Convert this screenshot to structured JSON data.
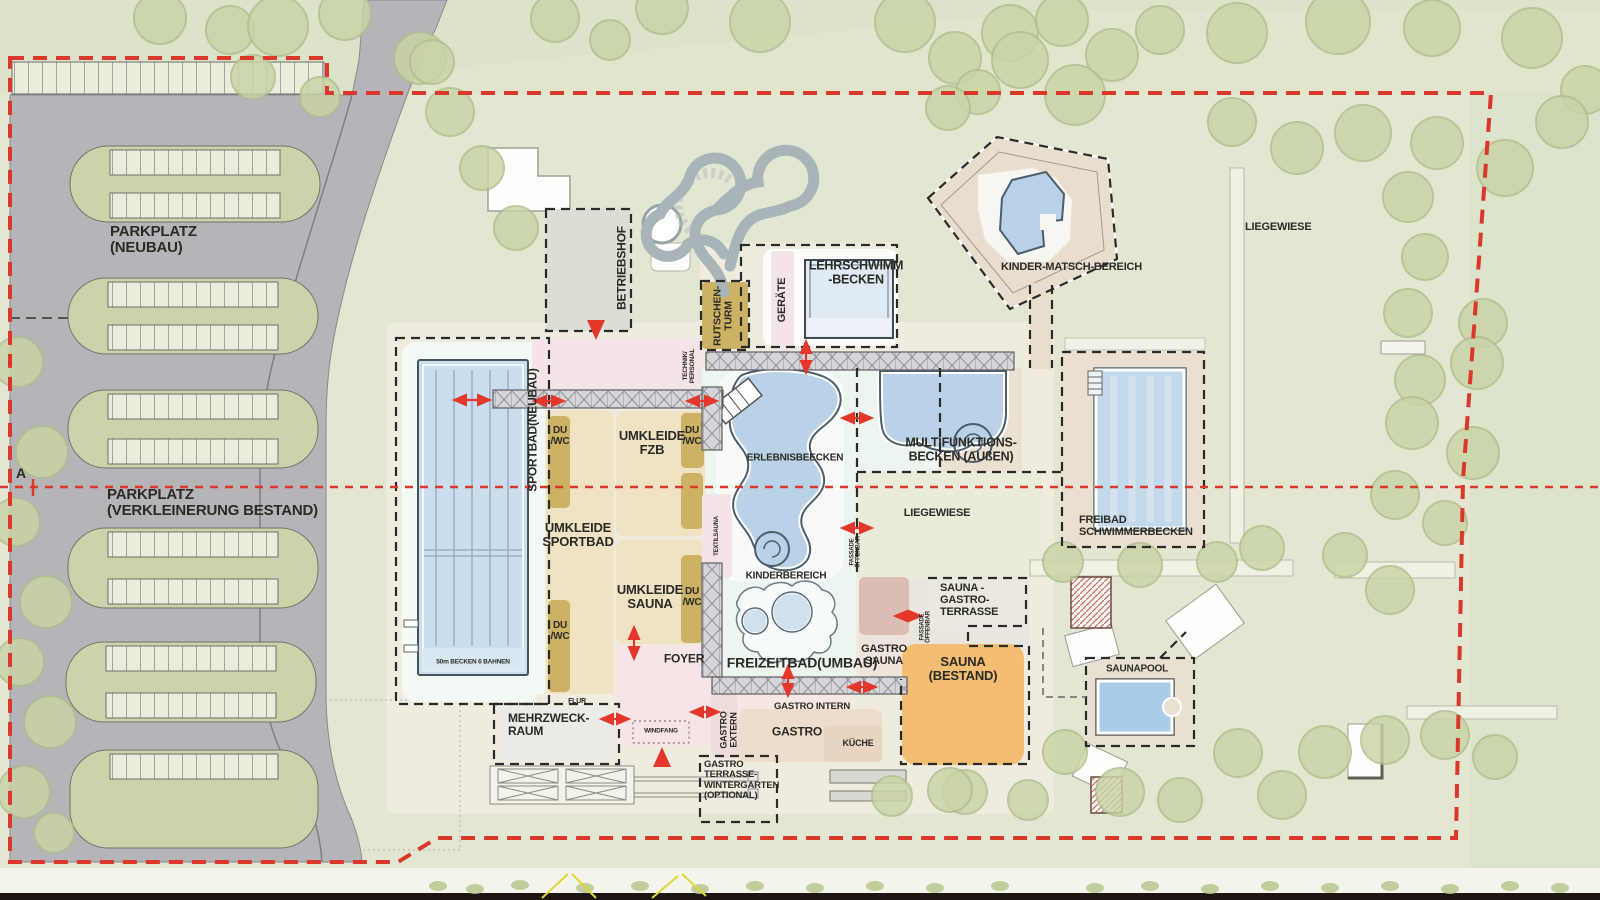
{
  "site": {
    "boundary_color": "#d9382b",
    "section_line_color": "#d9382b",
    "arrow_color": "#e2372a",
    "pool_color": "#b9d2e7",
    "sauna_orange": "#f3bd72",
    "gold": "#cdb266",
    "section_marker": "A"
  },
  "labels": [
    {
      "id": "parkplatz-neubau",
      "text": "PARKPLATZ\n(NEUBAU)",
      "x": 110,
      "y": 224,
      "s": 15,
      "a": "l"
    },
    {
      "id": "parkplatz-bestand",
      "text": "PARKPLATZ\n(VERKLEINERUNG BESTAND)",
      "x": 107,
      "y": 487,
      "s": 15,
      "a": "l"
    },
    {
      "id": "section-a",
      "text": "A",
      "x": 16,
      "y": 466,
      "s": 14,
      "a": "l"
    },
    {
      "id": "betriebshof",
      "text": "BETRIEBSHOF",
      "x": 622,
      "y": 268,
      "s": 12,
      "a": "r"
    },
    {
      "id": "rutschen-turm",
      "text": "RUTSCHEN-\nTURM",
      "x": 724,
      "y": 316,
      "s": 10.5,
      "a": "r"
    },
    {
      "id": "geraete",
      "text": "GERÄTE",
      "x": 783,
      "y": 300,
      "s": 11,
      "a": "r"
    },
    {
      "id": "lehrschwimm-becken",
      "text": "LEHRSCHWIMM\n-BECKEN",
      "x": 856,
      "y": 273,
      "s": 12.5,
      "a": "c"
    },
    {
      "id": "kinder-matsch-bereich",
      "text": "KINDER-MATSCH-BEREICH",
      "x": 1001,
      "y": 262,
      "s": 11,
      "a": "l"
    },
    {
      "id": "liegewiese-top",
      "text": "LIEGEWIESE",
      "x": 1245,
      "y": 222,
      "s": 11,
      "a": "l"
    },
    {
      "id": "sportbad-neubau",
      "text": "SPORTBAD(NEUBAU)",
      "x": 533,
      "y": 430,
      "s": 12,
      "a": "r"
    },
    {
      "id": "technik-personal",
      "text": "TECHNIK/\nPERSONAL",
      "x": 689,
      "y": 366,
      "s": 6.5,
      "a": "r"
    },
    {
      "id": "du-wc-1",
      "text": "DU\n/WC",
      "x": 560,
      "y": 437,
      "s": 10,
      "a": "c"
    },
    {
      "id": "du-wc-2",
      "text": "DU\n/WC",
      "x": 560,
      "y": 632,
      "s": 10,
      "a": "c"
    },
    {
      "id": "du-wc-3",
      "text": "DU\n/WC",
      "x": 692,
      "y": 437,
      "s": 10,
      "a": "c"
    },
    {
      "id": "du-wc-4",
      "text": "DU\n/WC",
      "x": 692,
      "y": 598,
      "s": 10,
      "a": "c"
    },
    {
      "id": "umkleide-fzb",
      "text": "UMKLEIDE\nFZB",
      "x": 652,
      "y": 443,
      "s": 13,
      "a": "c"
    },
    {
      "id": "umkleide-sportbad",
      "text": "UMKLEIDE\nSPORTBAD",
      "x": 578,
      "y": 535,
      "s": 13,
      "a": "c"
    },
    {
      "id": "umkleide-sauna",
      "text": "UMKLEIDE\nSAUNA",
      "x": 650,
      "y": 597,
      "s": 13,
      "a": "c"
    },
    {
      "id": "erlebnisbecken",
      "text": "ERLEBNISBEECKEN",
      "x": 795,
      "y": 459,
      "s": 10,
      "a": "c"
    },
    {
      "id": "multifunktionsbecken",
      "text": "MULTIFUNKTIONS-\nBECKEN (AUßEN)",
      "x": 961,
      "y": 450,
      "s": 12.5,
      "a": "c"
    },
    {
      "id": "liegewiese-mitte",
      "text": "LIEGEWIESE",
      "x": 937,
      "y": 514,
      "s": 11,
      "a": "c"
    },
    {
      "id": "freibad-schwimmerbecken",
      "text": "FREIBAD\nSCHWIMMERBECKEN",
      "x": 1079,
      "y": 515,
      "s": 11,
      "a": "l"
    },
    {
      "id": "textilsauna",
      "text": "TEXTILSAUNA",
      "x": 717,
      "y": 536,
      "s": 6,
      "a": "r"
    },
    {
      "id": "fassade-oeffenbar-1",
      "text": "FASSADE\nÖFFENBAR",
      "x": 856,
      "y": 552,
      "s": 6,
      "a": "r"
    },
    {
      "id": "fassade-oeffenbar-2",
      "text": "FASSADE\nÖFFENBAR",
      "x": 926,
      "y": 627,
      "s": 6,
      "a": "r"
    },
    {
      "id": "kinderbereich",
      "text": "KINDERBEREICH",
      "x": 786,
      "y": 577,
      "s": 10,
      "a": "c"
    },
    {
      "id": "freizeitbad-umbau",
      "text": "FREIZEITBAD(UMBAU)",
      "x": 802,
      "y": 663,
      "s": 14,
      "a": "c"
    },
    {
      "id": "sauna-gastro-terrasse",
      "text": "SAUNA -\nGASTRO-\nTERRASSE",
      "x": 940,
      "y": 583,
      "s": 11,
      "a": "l"
    },
    {
      "id": "gastro-sauna",
      "text": "GASTRO\nSAUNA",
      "x": 884,
      "y": 656,
      "s": 11,
      "a": "c"
    },
    {
      "id": "sauna-bestand",
      "text": "SAUNA\n(BESTAND)",
      "x": 963,
      "y": 669,
      "s": 13,
      "a": "c"
    },
    {
      "id": "saunapool",
      "text": "SAUNAPOOL",
      "x": 1137,
      "y": 670,
      "s": 10,
      "a": "c"
    },
    {
      "id": "foyer",
      "text": "FOYER",
      "x": 684,
      "y": 659,
      "s": 12,
      "a": "c"
    },
    {
      "id": "flur",
      "text": "FLUR",
      "x": 577,
      "y": 702,
      "s": 7,
      "a": "c"
    },
    {
      "id": "mehrzweck-raum",
      "text": "MEHRZWECK-\nRAUM",
      "x": 508,
      "y": 712,
      "s": 12,
      "a": "l"
    },
    {
      "id": "windfang",
      "text": "WINDFANG",
      "x": 661,
      "y": 731,
      "s": 6.5,
      "a": "c"
    },
    {
      "id": "gastro-extern",
      "text": "GASTRO\nEXTERN",
      "x": 729,
      "y": 730,
      "s": 9,
      "a": "r"
    },
    {
      "id": "gastro-intern",
      "text": "GASTRO INTERN",
      "x": 812,
      "y": 707,
      "s": 9.5,
      "a": "c"
    },
    {
      "id": "gastro",
      "text": "GASTRO",
      "x": 797,
      "y": 732,
      "s": 12,
      "a": "c"
    },
    {
      "id": "kueche",
      "text": "KÜCHE",
      "x": 858,
      "y": 744,
      "s": 9,
      "a": "c"
    },
    {
      "id": "gastro-terrasse-wintergarten",
      "text": "GASTRO\nTERRASSE-\nWINTERGARTEN\n(OPTIONAL)",
      "x": 704,
      "y": 760,
      "s": 9.5,
      "a": "l"
    },
    {
      "id": "becken-50m",
      "text": "50m BECKEN 6 BAHNEN",
      "x": 473,
      "y": 662,
      "s": 6.5,
      "a": "c"
    }
  ],
  "blocks": [
    {
      "id": "sportbad-halle",
      "x": 402,
      "y": 342,
      "w": 143,
      "h": 360,
      "bg": "#f3faf6",
      "rx": 14
    },
    {
      "id": "technik-strip",
      "x": 532,
      "y": 338,
      "w": 170,
      "h": 52,
      "bg": "#f5e4e7",
      "rx": 8
    },
    {
      "id": "betriebshof-hof",
      "x": 546,
      "y": 209,
      "w": 85,
      "h": 122,
      "bg": "#dcddd4",
      "rx": 2
    },
    {
      "id": "umkleide-sportbad-block",
      "x": 546,
      "y": 410,
      "w": 68,
      "h": 288,
      "bg": "#f0e3c3",
      "rx": 10
    },
    {
      "id": "umkleide-fzb-block",
      "x": 616,
      "y": 411,
      "w": 89,
      "h": 125,
      "bg": "#f0e3c3",
      "rx": 8
    },
    {
      "id": "umkleide-sauna-block",
      "x": 616,
      "y": 540,
      "w": 89,
      "h": 104,
      "bg": "#f0e3c3",
      "rx": 8
    },
    {
      "id": "foyer-block",
      "x": 616,
      "y": 646,
      "w": 95,
      "h": 100,
      "bg": "#f6e4e7",
      "rx": 8
    },
    {
      "id": "flur-strip",
      "x": 536,
      "y": 694,
      "w": 78,
      "h": 16,
      "bg": "#f0ecdf",
      "rx": 3
    },
    {
      "id": "du-wc-box-1",
      "x": 548,
      "y": 416,
      "w": 22,
      "h": 92,
      "bg": "#cdb266",
      "rx": 5
    },
    {
      "id": "du-wc-box-2",
      "x": 548,
      "y": 600,
      "w": 22,
      "h": 92,
      "bg": "#cdb266",
      "rx": 5
    },
    {
      "id": "du-wc-box-3",
      "x": 681,
      "y": 413,
      "w": 23,
      "h": 55,
      "bg": "#cdb266",
      "rx": 5
    },
    {
      "id": "du-wc-box-4",
      "x": 681,
      "y": 473,
      "w": 22,
      "h": 56,
      "bg": "#cdb266",
      "rx": 5
    },
    {
      "id": "du-wc-box-5",
      "x": 681,
      "y": 555,
      "w": 22,
      "h": 88,
      "bg": "#cdb266",
      "rx": 5
    },
    {
      "id": "textilsauna-box",
      "x": 702,
      "y": 494,
      "w": 30,
      "h": 84,
      "bg": "#f5e4e7",
      "rx": 4
    },
    {
      "id": "lehrschwimm-box",
      "x": 763,
      "y": 249,
      "w": 135,
      "h": 97,
      "bg": "#fcfdfb",
      "rx": 10
    },
    {
      "id": "geraete-strip",
      "x": 771,
      "y": 251,
      "w": 23,
      "h": 99,
      "bg": "#f5e4e7",
      "rx": 3
    },
    {
      "id": "rutschenturm-box",
      "x": 702,
      "y": 282,
      "w": 46,
      "h": 67,
      "bg": "#cdb266",
      "rx": 4
    },
    {
      "id": "mehrzweck-block",
      "x": 500,
      "y": 707,
      "w": 113,
      "h": 54,
      "bg": "#ebebe8",
      "rx": 8
    },
    {
      "id": "gastro-extern-box",
      "x": 711,
      "y": 694,
      "w": 37,
      "h": 64,
      "bg": "#eedcd8",
      "rx": 6
    },
    {
      "id": "gastro-intern-strip",
      "x": 737,
      "y": 693,
      "w": 113,
      "h": 26,
      "bg": "#f6e7e3",
      "rx": 4
    },
    {
      "id": "gastro-block",
      "x": 739,
      "y": 709,
      "w": 143,
      "h": 53,
      "bg": "#eedccd",
      "rx": 8
    },
    {
      "id": "kueche-block",
      "x": 824,
      "y": 726,
      "w": 58,
      "h": 36,
      "bg": "#e9d3c1",
      "rx": 4
    },
    {
      "id": "gastro-sauna-base",
      "x": 859,
      "y": 577,
      "w": 50,
      "h": 100,
      "bg": "#efe4dc",
      "rx": 6
    },
    {
      "id": "gastro-sauna-top",
      "x": 859,
      "y": 577,
      "w": 50,
      "h": 58,
      "bg": "#dcbdb5",
      "rx": 6
    },
    {
      "id": "sauna-terrasse-box",
      "x": 927,
      "y": 578,
      "w": 99,
      "h": 52,
      "bg": "#eae8e1",
      "rx": 2
    },
    {
      "id": "sauna-bestand-block",
      "x": 902,
      "y": 644,
      "w": 122,
      "h": 121,
      "bg": "#f3bd72",
      "rx": 14
    },
    {
      "id": "rutschen-basis-box",
      "x": 651,
      "y": 243,
      "w": 39,
      "h": 28,
      "bg": "#fdfdfb",
      "rx": 6,
      "st": "#b5b5ae",
      "sw": 1
    },
    {
      "id": "windfang-box",
      "x": 633,
      "y": 721,
      "w": 56,
      "h": 22,
      "bg": "none",
      "rx": 1,
      "st": "#8a8a8a",
      "sw": 1.4,
      "sd": "2 3"
    },
    {
      "id": "liege-bank",
      "x": 1381,
      "y": 341,
      "w": 44,
      "h": 13,
      "bg": "#f4f3ec",
      "rx": 1,
      "st": "#9a9a92",
      "sw": 1
    }
  ],
  "parking": {
    "islands": [
      {
        "x": 70,
        "y": 146,
        "w": 250,
        "h": 76,
        "rows": 2
      },
      {
        "x": 68,
        "y": 278,
        "w": 250,
        "h": 76,
        "rows": 2
      },
      {
        "x": 68,
        "y": 390,
        "w": 250,
        "h": 78,
        "rows": 2
      },
      {
        "x": 68,
        "y": 528,
        "w": 250,
        "h": 80,
        "rows": 2
      },
      {
        "x": 66,
        "y": 642,
        "w": 250,
        "h": 80,
        "rows": 2
      },
      {
        "x": 70,
        "y": 750,
        "w": 248,
        "h": 98,
        "rows": 1
      }
    ]
  },
  "trees": [
    [
      160,
      18,
      26
    ],
    [
      230,
      30,
      24
    ],
    [
      278,
      26,
      30
    ],
    [
      345,
      14,
      26
    ],
    [
      420,
      58,
      26
    ],
    [
      253,
      77,
      22
    ],
    [
      320,
      97,
      20
    ],
    [
      555,
      18,
      24
    ],
    [
      610,
      40,
      20
    ],
    [
      662,
      8,
      26
    ],
    [
      760,
      22,
      30
    ],
    [
      905,
      22,
      30
    ],
    [
      955,
      58,
      26
    ],
    [
      1010,
      33,
      28
    ],
    [
      1062,
      20,
      26
    ],
    [
      1112,
      55,
      26
    ],
    [
      978,
      92,
      22
    ],
    [
      1160,
      30,
      24
    ],
    [
      1237,
      33,
      30
    ],
    [
      1338,
      22,
      32
    ],
    [
      1432,
      28,
      28
    ],
    [
      1532,
      38,
      30
    ],
    [
      1585,
      90,
      24
    ],
    [
      1562,
      122,
      26
    ],
    [
      1505,
      168,
      28
    ],
    [
      1437,
      143,
      26
    ],
    [
      1363,
      133,
      28
    ],
    [
      1297,
      148,
      26
    ],
    [
      1232,
      122,
      24
    ],
    [
      1408,
      197,
      25
    ],
    [
      1425,
      257,
      23
    ],
    [
      1408,
      313,
      24
    ],
    [
      1483,
      323,
      24
    ],
    [
      1477,
      363,
      26
    ],
    [
      1420,
      380,
      25
    ],
    [
      1412,
      423,
      26
    ],
    [
      1473,
      453,
      26
    ],
    [
      1395,
      495,
      24
    ],
    [
      1445,
      523,
      22
    ],
    [
      450,
      112,
      24
    ],
    [
      482,
      168,
      22
    ],
    [
      516,
      228,
      22
    ],
    [
      432,
      62,
      22
    ],
    [
      18,
      362,
      25
    ],
    [
      42,
      452,
      26
    ],
    [
      16,
      522,
      24
    ],
    [
      46,
      602,
      26
    ],
    [
      20,
      662,
      24
    ],
    [
      50,
      722,
      26
    ],
    [
      24,
      792,
      26
    ],
    [
      54,
      833,
      20
    ],
    [
      1325,
      752,
      26
    ],
    [
      1385,
      740,
      24
    ],
    [
      1445,
      735,
      24
    ],
    [
      1495,
      757,
      22
    ],
    [
      1238,
      753,
      24
    ],
    [
      1180,
      800,
      22
    ],
    [
      1120,
      792,
      24
    ],
    [
      1282,
      795,
      24
    ],
    [
      1065,
      752,
      22
    ],
    [
      1028,
      800,
      20
    ],
    [
      965,
      792,
      22
    ],
    [
      892,
      796,
      20
    ],
    [
      950,
      790,
      22
    ],
    [
      1020,
      60,
      28
    ],
    [
      1075,
      95,
      30
    ],
    [
      948,
      108,
      22
    ],
    [
      1063,
      562,
      20
    ],
    [
      1140,
      565,
      22
    ],
    [
      1217,
      562,
      20
    ],
    [
      1262,
      548,
      22
    ],
    [
      1345,
      555,
      22
    ],
    [
      1390,
      590,
      24
    ]
  ],
  "bushes": [
    [
      438,
      886
    ],
    [
      475,
      889
    ],
    [
      520,
      885
    ],
    [
      585,
      888
    ],
    [
      640,
      886
    ],
    [
      700,
      889
    ],
    [
      755,
      886
    ],
    [
      815,
      888
    ],
    [
      875,
      886
    ],
    [
      935,
      888
    ],
    [
      1000,
      886
    ],
    [
      1095,
      888
    ],
    [
      1150,
      886
    ],
    [
      1210,
      889
    ],
    [
      1270,
      886
    ],
    [
      1330,
      888
    ],
    [
      1390,
      886
    ],
    [
      1450,
      889
    ],
    [
      1510,
      886
    ],
    [
      1560,
      888
    ]
  ],
  "arrows": [
    [
      455,
      400,
      489,
      400
    ],
    [
      535,
      401,
      563,
      401
    ],
    [
      688,
      401,
      716,
      401
    ],
    [
      806,
      342,
      806,
      372
    ],
    [
      843,
      418,
      871,
      418
    ],
    [
      843,
      528,
      871,
      528
    ],
    [
      849,
      687,
      875,
      687
    ],
    [
      634,
      628,
      634,
      658
    ],
    [
      692,
      712,
      718,
      712
    ],
    [
      602,
      719,
      628,
      719
    ],
    [
      896,
      616,
      920,
      616
    ],
    [
      788,
      667,
      788,
      695
    ]
  ],
  "triangles": [
    {
      "id": "eingang-betriebshof",
      "dir": "down",
      "x": 587,
      "y": 320
    },
    {
      "id": "haupteingang",
      "dir": "up",
      "x": 653,
      "y": 747
    }
  ]
}
